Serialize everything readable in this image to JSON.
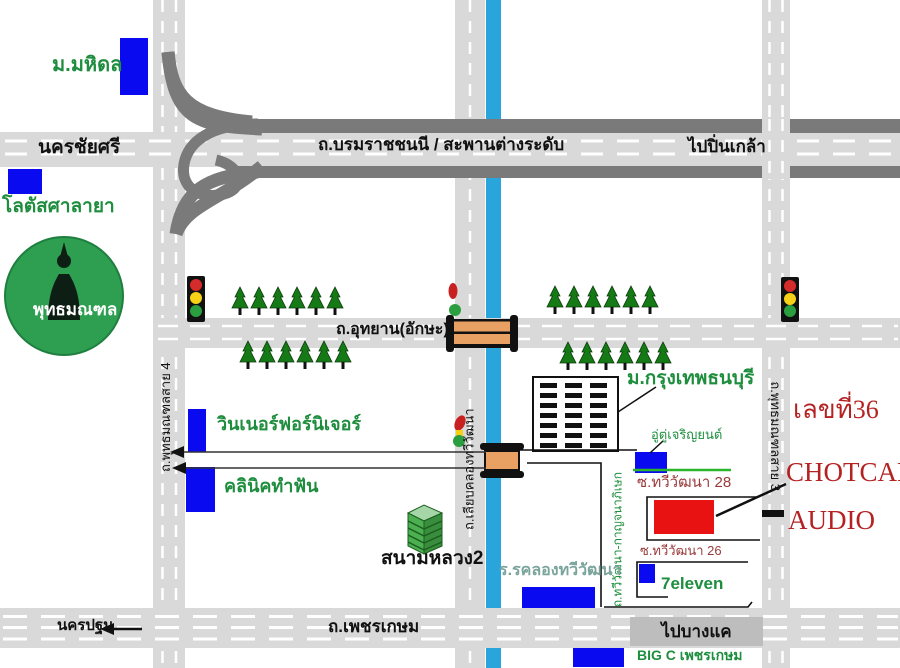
{
  "labels": {
    "mahidol_univ": "ม.มหิดล",
    "lotus_salaya": "โลตัสศาลายา",
    "nakhon_chai_si": "นครชัยศรี",
    "borommaratchachonnani_road": "ถ.บรมราชชนนี   /   สะพานต่างระดับ",
    "to_pinklao": "ไปปิ่นเกล้า",
    "phutthamonthon": "พุทธมณฑล",
    "utthayan_road": "ถ.อุทยาน(อักษะ)",
    "sai4_road": "ถ.พุทธมณฑลสาย 4",
    "sai3_road": "ถ.พุทธมณฑลสาย 3",
    "liap_khlong_road": "ถ.เลียบคลองทวีวัฒนา",
    "bangkokthonburi_univ": "ม.กรุงเทพธนบุรี",
    "house_number": "เลขที่36",
    "shop_name_line1": "CHOTCAR",
    "shop_name_line2": "AUDIO",
    "winner_furniture": "วินเนอร์ฟอร์นิเจอร์",
    "dental_clinic": "คลินิคทำฟัน",
    "garage_tu_charoenyon": "อู่ตู่เจริญยนต์",
    "soi_thawiwatthana_28": "ซ.ทวีวัฒนา 28",
    "soi_thawiwatthana_26": "ซ.ทวีวัฒนา 26",
    "seven_eleven": "7eleven",
    "thawiwatthana_kanchanaphisek_road": "ถ.ทวีวัฒนา-กาญจนาภิเษก",
    "khlong_thawiwatthana_school": "ร.รคลองทวีวัฒนา",
    "sanam_luang_2": "สนามหลวง2",
    "nakhon_pathom": "นครปฐม",
    "phetkasem_road": "ถ.เพชรเกษม",
    "to_bang_khae": "ไปบางแค",
    "big_c_phetkasem": "BIG C เพชรเกษม"
  },
  "colors": {
    "canal_blue": "#2AA5DC",
    "road_light_gray": "#D9D9D9",
    "road_dark_gray": "#7A7A7A",
    "building_blue": "#0A0AF0",
    "shop_red": "#E91212",
    "label_green": "#1E8E3E",
    "shop_label_red": "#B52222",
    "soi_label_maroon": "#9A3A3A",
    "tree_green": "#157A15",
    "phutthamonthon_circle_green": "#2E9E50",
    "direction_box_gray": "#BDBDBD",
    "school_label_teal": "#7AA49C",
    "bridge_orange": "#E9A163"
  },
  "icons": {
    "tree": "pine-tree",
    "traffic_light": "red-yellow-green-signal",
    "bridge": "orange-canal-bridge",
    "statue": "buddha-statue-silhouette",
    "arrow": "left-arrow"
  }
}
